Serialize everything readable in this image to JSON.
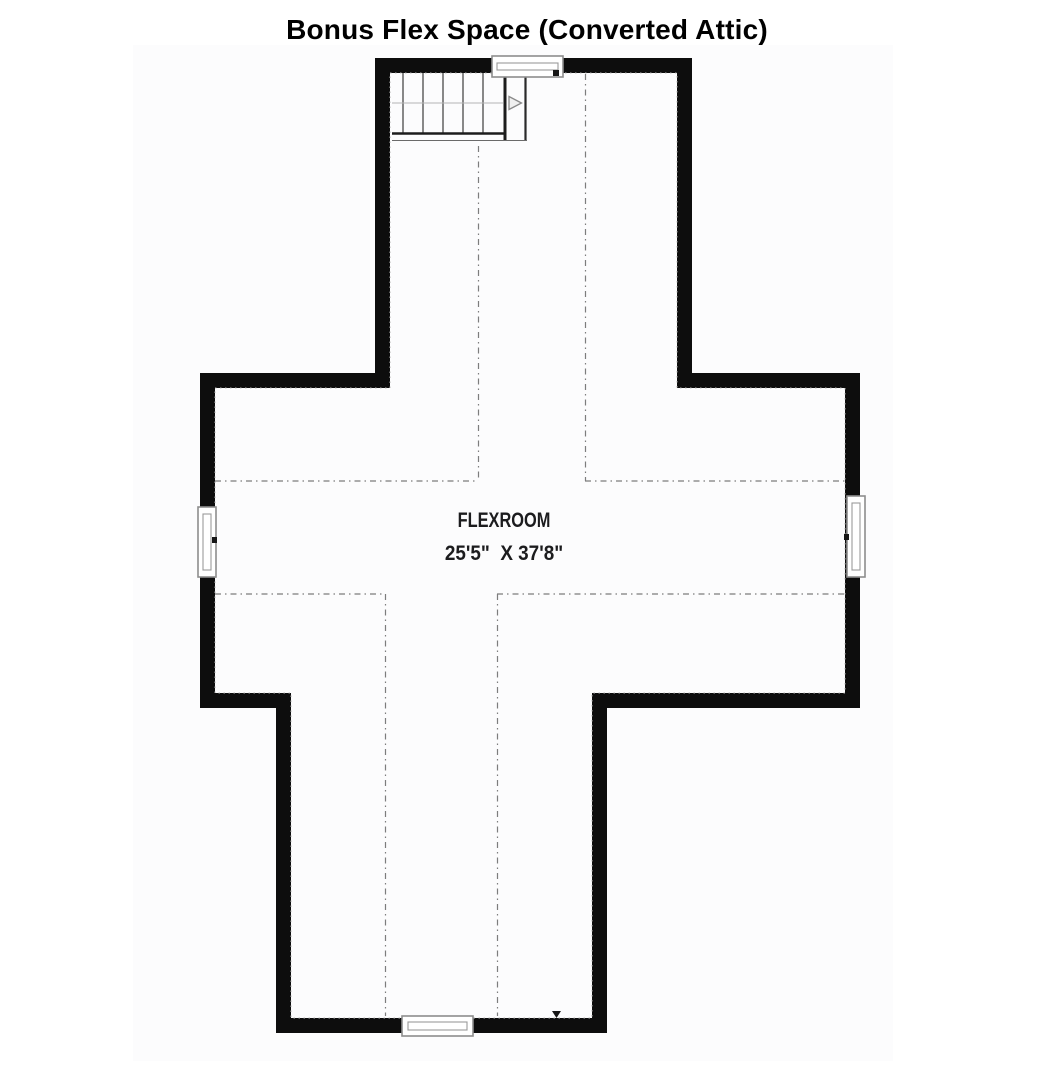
{
  "title": "Bonus Flex Space (Converted Attic)",
  "room": {
    "name": "FLEXROOM",
    "dimensions": "25'5\"  X 37'8\""
  },
  "icons": {
    "stair_direction": "right-arrow",
    "floor_marker": "down-triangle"
  },
  "features": {
    "staircase": "straight-run stairs, top-left wing",
    "windows": [
      "top",
      "left",
      "right",
      "bottom"
    ],
    "ceiling_break_lines": "dotted knee-wall lines forming cross-shaped full-height zone"
  },
  "colors": {
    "wall": "#0d0d0d",
    "panel": "#fcfcfd",
    "knee_line": "#7d7d7d",
    "eave_line": "#b3b3b3",
    "window_frame": "#8d8d8d",
    "marker": "#161616",
    "title_text": "#000000",
    "room_text": "#1c1c1e"
  }
}
